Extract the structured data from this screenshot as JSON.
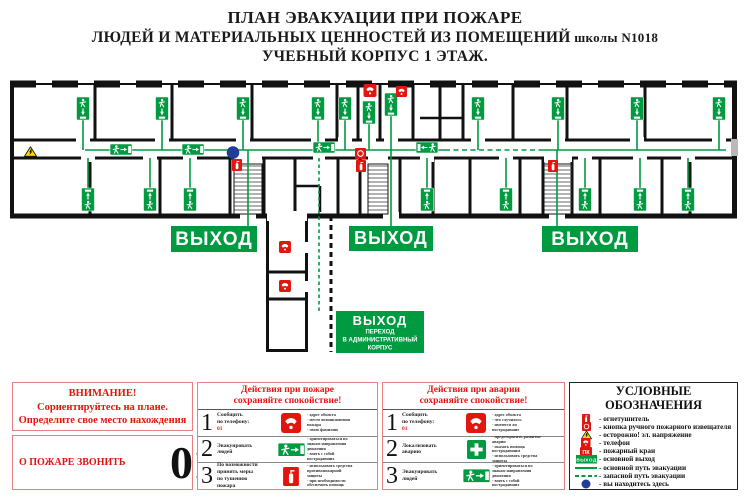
{
  "title": {
    "line1": "ПЛАН ЭВАКУАЦИИ ПРИ ПОЖАРЕ",
    "line2": "ЛЮДЕЙ И МАТЕРИАЛЬНЫХ ЦЕННОСТЕЙ ИЗ ПОМЕЩЕНИЙ",
    "line2_suffix": " школы N1018",
    "line3": "УЧЕБНЫЙ КОРПУС 1 ЭТАЖ."
  },
  "plan": {
    "exit_label": "ВЫХОД",
    "transition": {
      "line1": "ВЫХОД",
      "line2": "ПЕРЕХОД",
      "line3": "В АДМИНИСТРАТИВНЫЙ",
      "line4": "КОРПУС"
    }
  },
  "attention": {
    "heading": "ВНИМАНИЕ!",
    "line2": "Сориентируйтесь на плане.",
    "line3": "Определите свое место нахождения",
    "call_label": "О ПОЖАРЕ ЗВОНИТЬ",
    "call_number": "01"
  },
  "fire": {
    "title_line1": "Действия при пожаре",
    "title_line2": "сохраняйте спокойствие!",
    "rows": [
      {
        "num": "1",
        "action": "Сообщить\nпо телефону:",
        "highlight": "01",
        "notes": "- адрес объекта\n- место возникновения\n  пожара\n- свою фамилию"
      },
      {
        "num": "2",
        "action": "Эвакуировать\nлюдей",
        "notes": "- ориентироваться по\n  знакам направления\n  движения\n- взять с собой\n  пострадавших"
      },
      {
        "num": "3",
        "action": "По возможности\nпринять меры\nпо тушению\nпожара",
        "notes": "- использовать средства\n  противопожарной\n  защиты\n- при необходимости\n  обеспечить помощь"
      }
    ]
  },
  "accident": {
    "title_line1": "Действия при аварии",
    "title_line2": "сохраняйте спокойствие!",
    "rows": [
      {
        "num": "1",
        "action": "Сообщить\nпо телефону:",
        "highlight": "01",
        "notes": "- адрес объекта\n- что случилось\n- имеются ли\n  пострадавшие"
      },
      {
        "num": "2",
        "action": "Локализовать\nаварию",
        "notes": "- предотвратить развитие\n  аварии\n- оказать помощь\n  пострадавшим\n- использовать средства\n  защиты"
      },
      {
        "num": "3",
        "action": "Эвакуировать\nлюдей",
        "notes": "- ориентироваться по\n  знакам направления\n  движения\n- взять с собой\n  пострадавших"
      }
    ]
  },
  "legend": {
    "title": "УСЛОВНЫЕ ОБОЗНАЧЕНИЯ",
    "exit_box_label": "ВЫХОД",
    "pk_label": "ПК",
    "items": [
      {
        "label": "- огнетушитель"
      },
      {
        "label": "- кнопка ручного пожарного извещателя"
      },
      {
        "label": "- осторожно! эл. напряжение"
      },
      {
        "label": "- телефон"
      },
      {
        "label": "- пожарный кран"
      },
      {
        "label": "- основной выход"
      },
      {
        "label": "- основной путь эвакуации"
      },
      {
        "label": "- запасной путь эвакуации"
      },
      {
        "label": "- вы находитесь здесь"
      }
    ]
  },
  "colors": {
    "green": "#009a40",
    "red": "#e3150f",
    "blue": "#1f3d99",
    "yellow": "#ffd400",
    "wall": "#111111"
  }
}
